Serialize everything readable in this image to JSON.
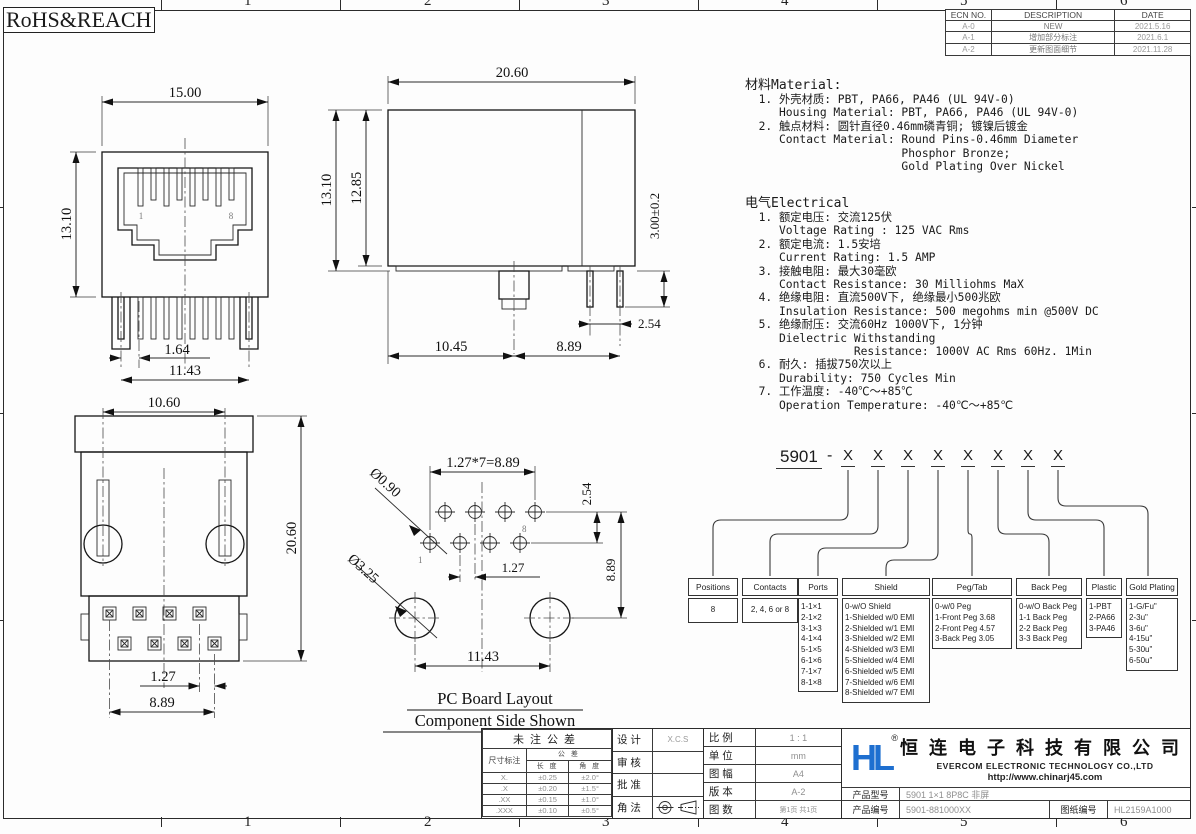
{
  "header": {
    "rohs": "RoHS&REACH"
  },
  "frame": {
    "zones": [
      "1",
      "2",
      "3",
      "4",
      "5",
      "6"
    ]
  },
  "ecn": {
    "headers": [
      "ECN NO.",
      "DESCRIPTION",
      "DATE"
    ],
    "rows": [
      [
        "A-0",
        "NEW",
        "2021.5.16"
      ],
      [
        "A-1",
        "增加部分标注",
        "2021.6.1"
      ],
      [
        "A-2",
        "更新图面细节",
        "2021.11.28"
      ]
    ]
  },
  "material": {
    "title": "材料Material:",
    "lines": [
      "  1. 外壳材质: PBT, PA66, PA46 (UL 94V-0)",
      "     Housing Material: PBT, PA66, PA46 (UL 94V-0)",
      "  2. 触点材料: 圆针直径0.46mm磷青铜; 镀镍后镀金",
      "     Contact Material: Round Pins-0.46mm Diameter",
      "                       Phosphor Bronze;",
      "                       Gold Plating Over Nickel"
    ]
  },
  "electrical": {
    "title": "电气Electrical",
    "lines": [
      "  1. 额定电压: 交流125伏",
      "     Voltage Rating : 125 VAC Rms",
      "  2. 额定电流: 1.5安培",
      "     Current Rating: 1.5 AMP",
      "  3. 接触电阻: 最大30毫欧",
      "     Contact Resistance: 30 Milliohms MaX",
      "  4. 绝缘电阻: 直流500V下, 绝缘最小500兆欧",
      "     Insulation Resistance: 500 megohms min @500V DC",
      "  5. 绝缘耐压: 交流60Hz 1000V下, 1分钟",
      "     Dielectric Withstanding",
      "                Resistance: 1000V AC Rms 60Hz. 1Min",
      "  6. 耐久: 插拔750次以上",
      "     Durability: 750 Cycles Min",
      "  7. 工作温度: -40℃～+85℃",
      "     Operation Temperature: -40℃～+85℃"
    ]
  },
  "views": {
    "front": {
      "w": "15.00",
      "h": "13.10",
      "pin_offset": "1.64",
      "pin_span": "11.43",
      "first_pin": "1",
      "last_pin": "8"
    },
    "side": {
      "depth": "20.60",
      "h": "13.10",
      "h2": "12.85",
      "pin_len": "3.00±0.2",
      "pin_pitch": "2.54",
      "front_len": "10.45",
      "back_len": "8.89"
    },
    "bottom": {
      "peg_span": "10.60",
      "total_h": "20.60",
      "row_offset": "1.27",
      "pin_span": "8.89"
    },
    "pcb": {
      "pitch_eq": "1.27*7=8.89",
      "row_gap": "2.54",
      "hole_span": "8.89",
      "hole_dia": "Ø0.90",
      "peg_dia": "Ø3.25",
      "half_pitch": "1.27",
      "peg_span": "11.43",
      "first": "1",
      "last": "8",
      "caption1": "PC Board Layout",
      "caption2": "Component Side Shown"
    }
  },
  "pn": {
    "prefix": "5901",
    "dash": "-",
    "digits": [
      "X",
      "X",
      "X",
      "X",
      "X",
      "X",
      "X",
      "X"
    ],
    "positions": {
      "title": "Positions",
      "items": [
        "8"
      ]
    },
    "contacts": {
      "title": "Contacts",
      "items": [
        "2, 4, 6 or 8"
      ]
    },
    "ports": {
      "title": "Ports",
      "items": [
        "1-1×1",
        "2-1×2",
        "3-1×3",
        "4-1×4",
        "5-1×5",
        "6-1×6",
        "7-1×7",
        "8-1×8"
      ]
    },
    "shield": {
      "title": "Shield",
      "items": [
        "0-w/O Shield",
        "1-Shielded w/0 EMI",
        "2-Shielded w/1 EMI",
        "3-Shielded w/2 EMI",
        "4-Shielded w/3 EMI",
        "5-Shielded w/4 EMI",
        "6-Shielded w/5 EMI",
        "7-Shielded w/6 EMI",
        "8-Shielded w/7 EMI"
      ]
    },
    "pegtab": {
      "title": "Peg/Tab",
      "items": [
        "0-w/0 Peg",
        "1-Front Peg 3.68",
        "2-Front Peg 4.57",
        "3-Back Peg 3.05"
      ]
    },
    "backpeg": {
      "title": "Back Peg",
      "items": [
        "0-w/O Back Peg",
        "1-1 Back Peg",
        "2-2 Back Peg",
        "3-3 Back Peg"
      ]
    },
    "plastic": {
      "title": "Plastic",
      "items": [
        "1-PBT",
        "2-PA66",
        "3-PA46"
      ]
    },
    "gold": {
      "title": "Gold Plating",
      "items": [
        "1-G/Fu\"",
        "2-3u\"",
        "3-6u\"",
        "4-15u\"",
        "5-30u\"",
        "6-50u\""
      ]
    }
  },
  "title_block": {
    "tolerance": {
      "title": "未注公差",
      "col1": "尺寸标注",
      "col2": "公  差",
      "sub1": "长 度",
      "sub2": "角 度",
      "rows": [
        [
          "X.",
          "±0.25",
          "±2.0°"
        ],
        [
          ".X",
          "±0.20",
          "±1.5°"
        ],
        [
          ".XX",
          "±0.15",
          "±1.0°"
        ],
        [
          ".XXX",
          "±0.10",
          "±0.5°"
        ]
      ]
    },
    "approval": {
      "design_label": "设 计",
      "design_value": "X.C.S",
      "review_label": "审 核",
      "review_value": "",
      "approve_label": "批 准",
      "approve_value": "",
      "angle_label": "角 法"
    },
    "info": {
      "scale_label": "比 例",
      "scale": "1 : 1",
      "unit_label": "单 位",
      "unit": "mm",
      "size_label": "图 幅",
      "size": "A4",
      "version_label": "版 本",
      "version": "A-2",
      "sheets_label": "图 数",
      "sheets": "第1页  共1页"
    },
    "company": {
      "logo": "HL",
      "reg": "®",
      "name_cn": "恒连电子科技有限公司",
      "name_en": "EVERCOM ELECTRONIC TECHNOLOGY CO.,LTD",
      "url": "http://www.chinarj45.com",
      "model_label": "产品型号",
      "model": "5901 1×1 8P8C 非屏",
      "pn_label": "产品编号",
      "pn": "5901-881000XX",
      "dwg_label": "图纸编号",
      "dwg": "HL2159A1000",
      "brand_color": "#1E6FD0"
    }
  }
}
